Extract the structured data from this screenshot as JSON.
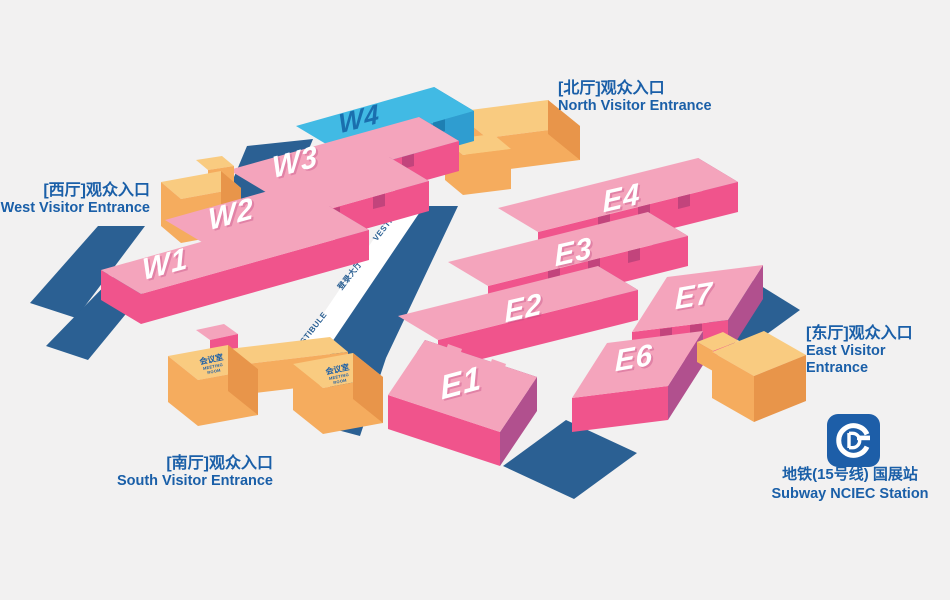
{
  "canvas": {
    "width": 950,
    "height": 600
  },
  "halls": [
    {
      "id": "W1",
      "label": "W1",
      "roof": "pink"
    },
    {
      "id": "W2",
      "label": "W2",
      "roof": "pink"
    },
    {
      "id": "W3",
      "label": "W3",
      "roof": "pink"
    },
    {
      "id": "W4",
      "label": "W4",
      "roof": "blue"
    },
    {
      "id": "E1",
      "label": "E1",
      "roof": "pink"
    },
    {
      "id": "E2",
      "label": "E2",
      "roof": "pink"
    },
    {
      "id": "E3",
      "label": "E3",
      "roof": "pink"
    },
    {
      "id": "E4",
      "label": "E4",
      "roof": "pink"
    },
    {
      "id": "E6",
      "label": "E6",
      "roof": "pink"
    },
    {
      "id": "E7",
      "label": "E7",
      "roof": "pink"
    }
  ],
  "entrances": {
    "north": {
      "cn": "[北厅]观众入口",
      "en": "North Visitor Entrance"
    },
    "west": {
      "cn": "[西厅]观众入口",
      "en": "West Visitor Entrance"
    },
    "south": {
      "cn": "[南厅]观众入口",
      "en": "South Visitor Entrance"
    },
    "east": {
      "cn": "[东厅]观众入口",
      "en": "East Visitor Entrance"
    }
  },
  "corridor": {
    "vestibule": "VESTIBULE",
    "vestibule_cn": "登录大厅"
  },
  "meeting_room": {
    "cn": "会议室",
    "en_line1": "MEETING",
    "en_line2": "ROOM"
  },
  "subway": {
    "cn": "地铁(15号线) 国展站",
    "en": "Subway NCIEC Station",
    "icon": "beijing-subway-logo"
  },
  "colors": {
    "background": "#F2F1F1",
    "text_blue": "#1A5FA8",
    "plaza_blue": "#2B6093",
    "strip_white": "#FFFFFF",
    "hall_pink_top": "#F4A4BC",
    "hall_pink_front": "#F0548C",
    "hall_pink_side": "#B1508E",
    "hall_pink_slot": "#C2447C",
    "hall_blue_top": "#41BAE4",
    "hall_blue_front": "#2F9DD0",
    "hall_blue_side": "#2386BD",
    "orange_top": "#F9CB80",
    "orange_front": "#F5AC5E",
    "orange_side": "#E8954A"
  }
}
